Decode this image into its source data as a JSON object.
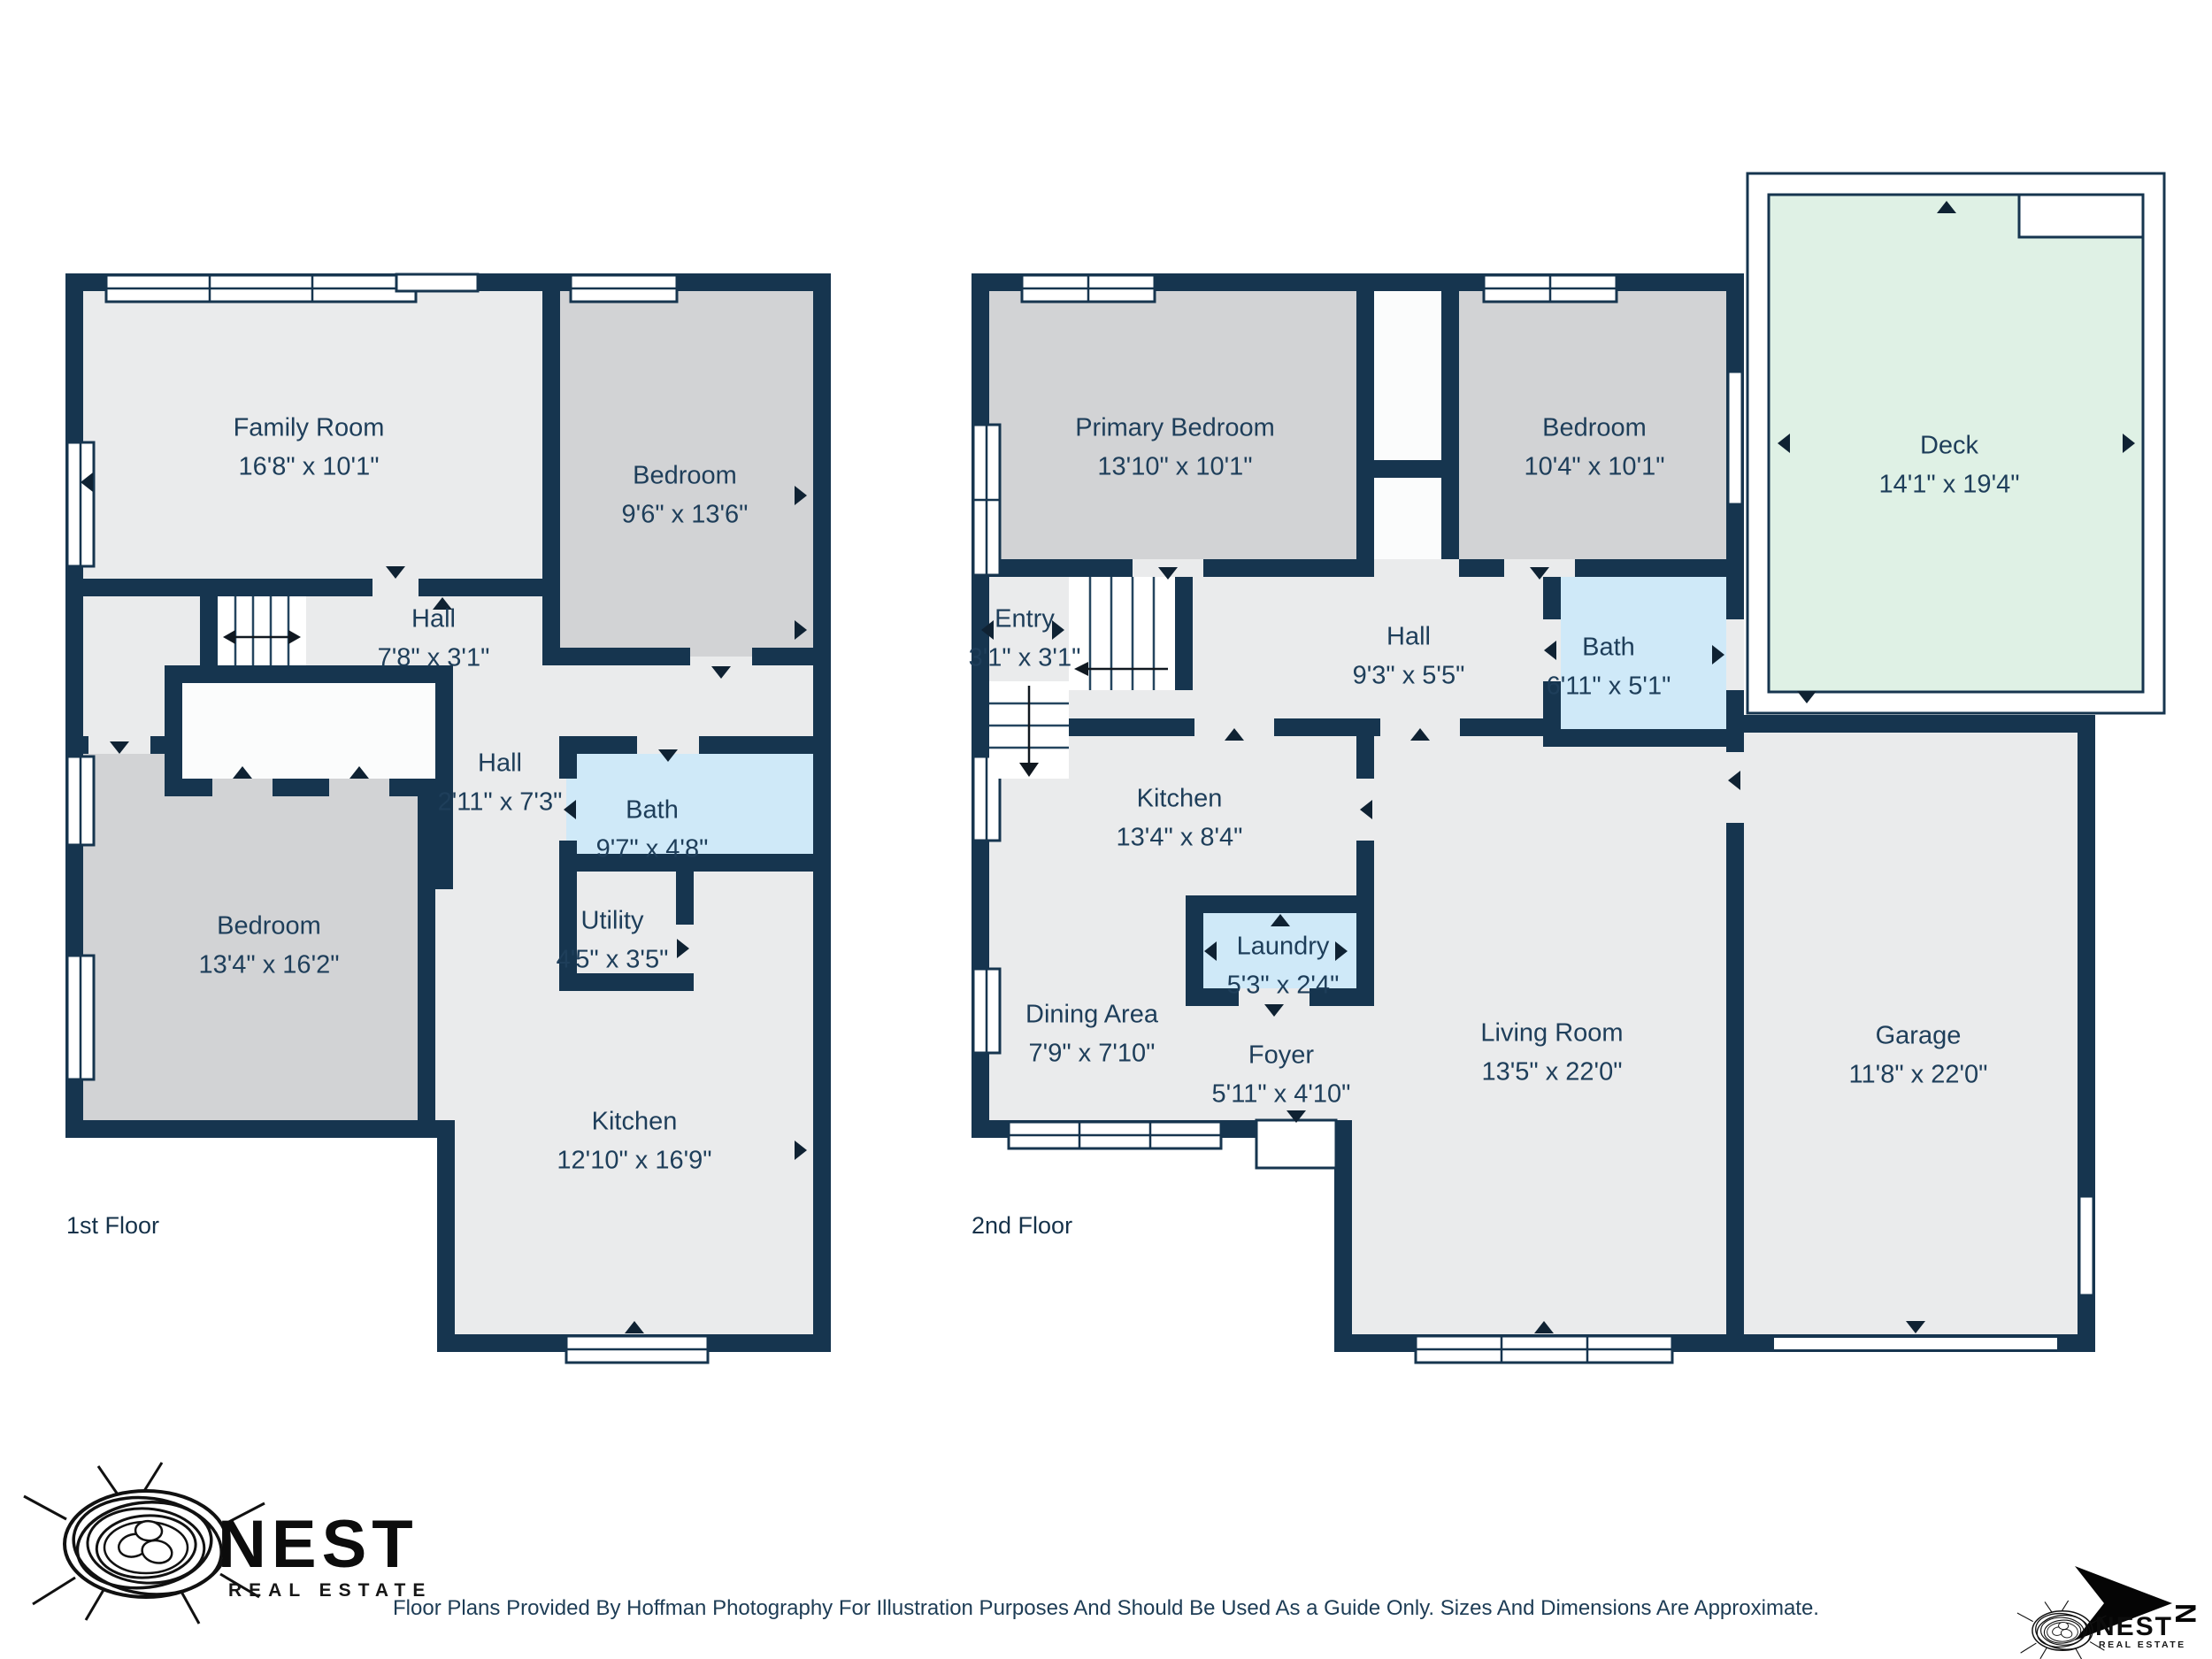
{
  "palette": {
    "wall": "#16354f",
    "room": "#eaebec",
    "bedroom": "#d2d3d5",
    "bath": "#cfe9f8",
    "deck": "#dff1e5",
    "closet": "#fbfcfc",
    "label": "#1e3e5a"
  },
  "floors": [
    {
      "title": "1st Floor",
      "rooms": [
        {
          "name": "Family Room",
          "dims": "16'8\" x 10'1\""
        },
        {
          "name": "Bedroom",
          "dims": "9'6\" x 13'6\""
        },
        {
          "name": "Hall",
          "dims": "7'8\" x 3'1\""
        },
        {
          "name": "Hall",
          "dims": "2'11\" x 7'3\""
        },
        {
          "name": "Bath",
          "dims": "9'7\" x 4'8\""
        },
        {
          "name": "Utility",
          "dims": "4'5\" x 3'5\""
        },
        {
          "name": "Bedroom",
          "dims": "13'4\" x 16'2\""
        },
        {
          "name": "Kitchen",
          "dims": "12'10\" x 16'9\""
        }
      ]
    },
    {
      "title": "2nd Floor",
      "rooms": [
        {
          "name": "Primary Bedroom",
          "dims": "13'10\" x 10'1\""
        },
        {
          "name": "Bedroom",
          "dims": "10'4\" x 10'1\""
        },
        {
          "name": "Deck",
          "dims": "14'1\" x 19'4\""
        },
        {
          "name": "Entry",
          "dims": "3'1\" x 3'1\""
        },
        {
          "name": "Hall",
          "dims": "9'3\" x 5'5\""
        },
        {
          "name": "Bath",
          "dims": "6'11\" x 5'1\""
        },
        {
          "name": "Kitchen",
          "dims": "13'4\" x 8'4\""
        },
        {
          "name": "Laundry",
          "dims": "5'3\" x 2'4\""
        },
        {
          "name": "Dining Area",
          "dims": "7'9\" x 7'10\""
        },
        {
          "name": "Foyer",
          "dims": "5'11\" x 4'10\""
        },
        {
          "name": "Living Room",
          "dims": "13'5\" x 22'0\""
        },
        {
          "name": "Garage",
          "dims": "11'8\" x 22'0\""
        }
      ]
    }
  ],
  "branding": {
    "logo": {
      "name": "NEST",
      "subtitle": "REAL ESTATE"
    },
    "compass_letter": "N"
  },
  "disclaimer": "Floor Plans Provided By Hoffman Photography For Illustration Purposes And Should Be Used As a Guide Only. Sizes And Dimensions Are Approximate."
}
